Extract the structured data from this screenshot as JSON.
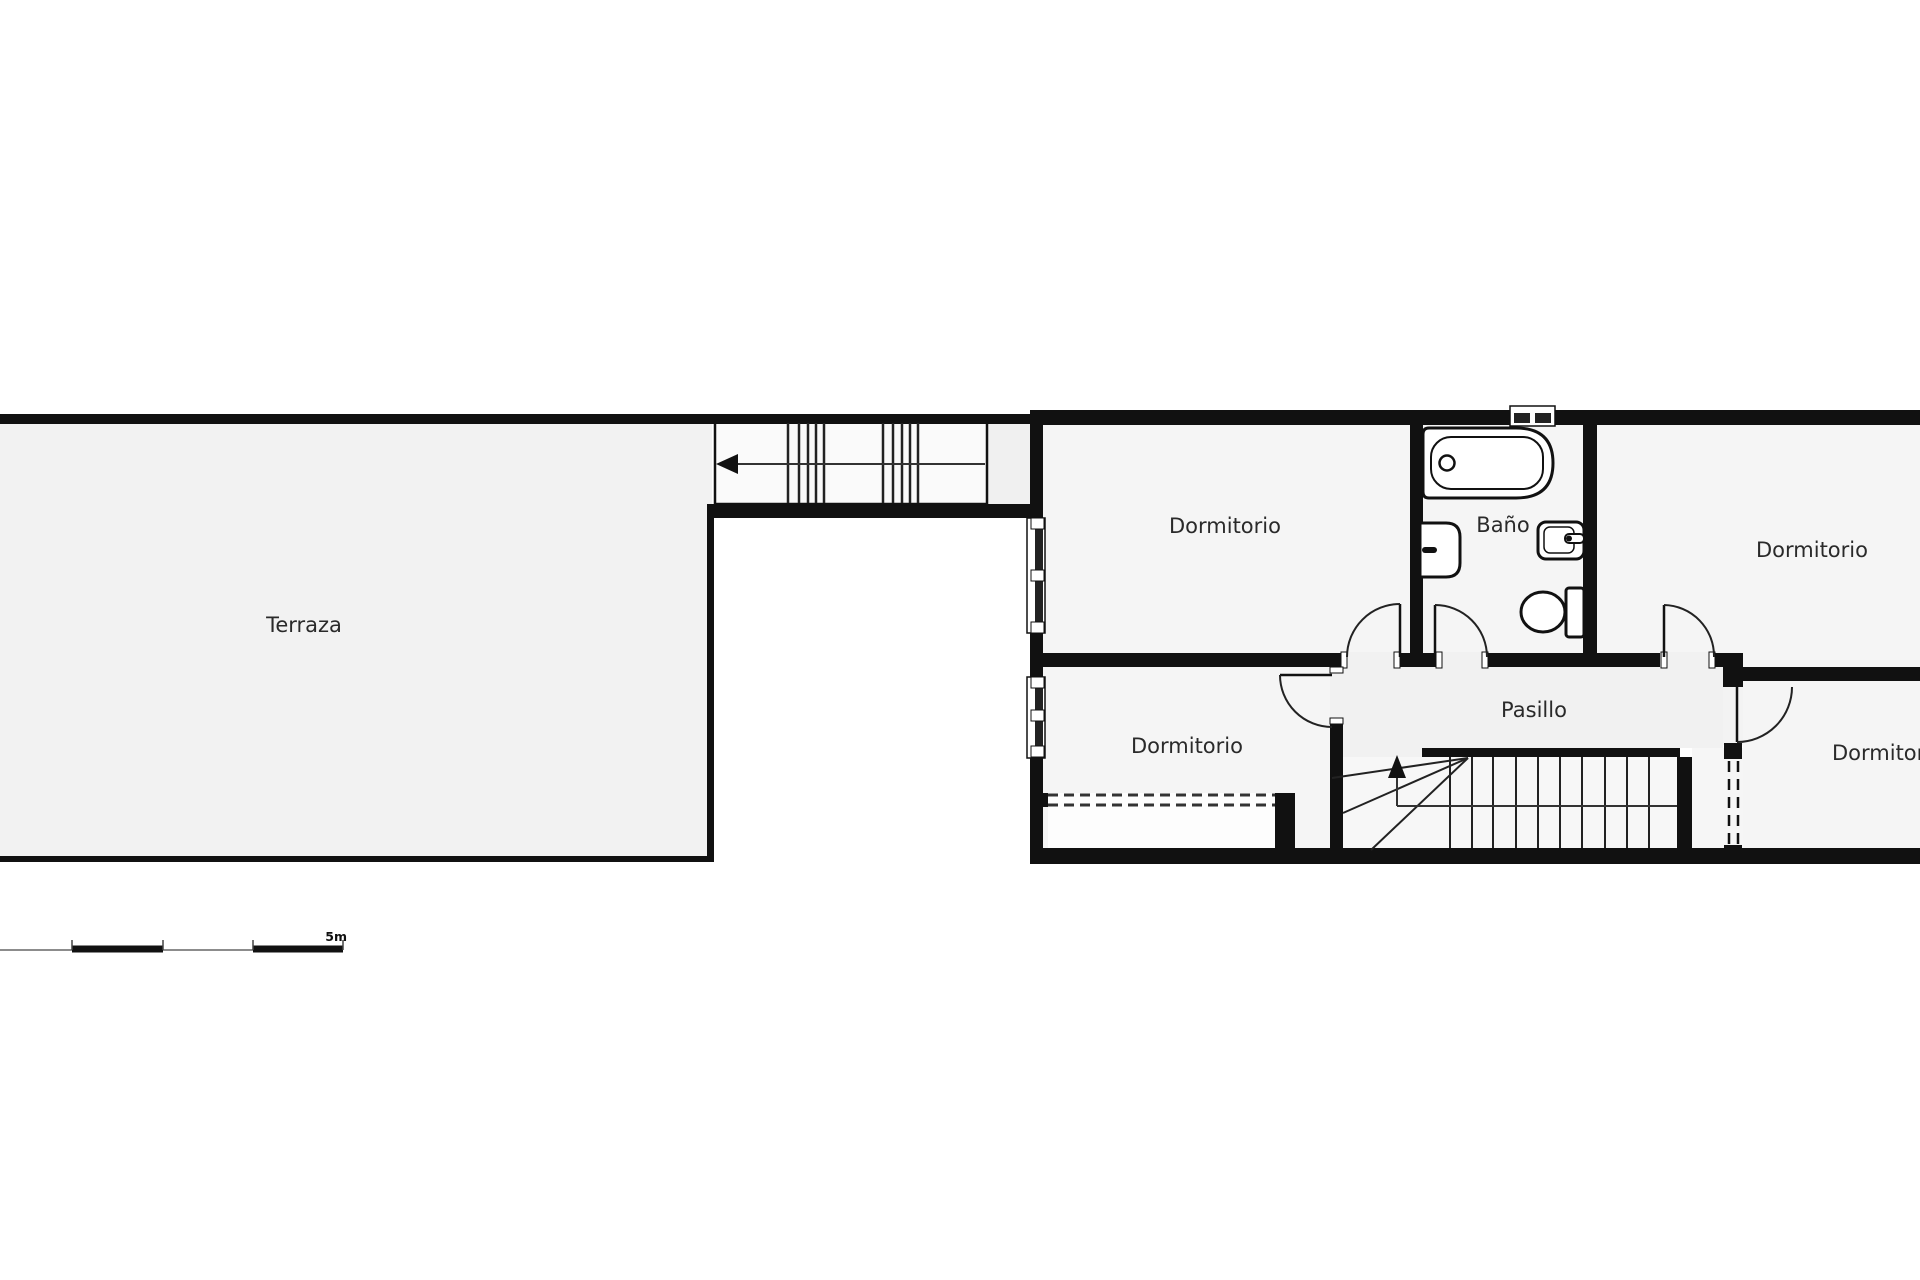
{
  "plan_labels": {
    "terraza": "Terraza",
    "bedroom_top_left": "Dormitorio",
    "bathroom": "Baño",
    "bedroom_top_right": "Dormitorio",
    "bedroom_bottom_left": "Dormitorio",
    "hallway": "Pasillo",
    "bedroom_bottom_right": "Dormitorio",
    "scale_label": "5m"
  },
  "icons": {
    "bathtub": "bathtub-icon",
    "washbasin_left": "washbasin-icon",
    "washbasin_right": "washbasin-icon",
    "toilet": "toilet-icon",
    "stairs_up_arrow": "stairs-direction-arrow-icon",
    "corridor_arrow": "stairs-direction-arrow-icon"
  },
  "colors": {
    "wall": "#111111",
    "room_fill": "#f5f5f5",
    "terrace_fill": "#f2f2f2",
    "hallway_fill": "#f1f1f1",
    "stair_fill": "#f7f7f7",
    "corridor_fill": "#fafafa",
    "landing_fill": "#f0f0f0",
    "wardrobe_fill": "#fdfdfd",
    "outside": "#ffffff",
    "label_text": "#2a2a2a"
  }
}
